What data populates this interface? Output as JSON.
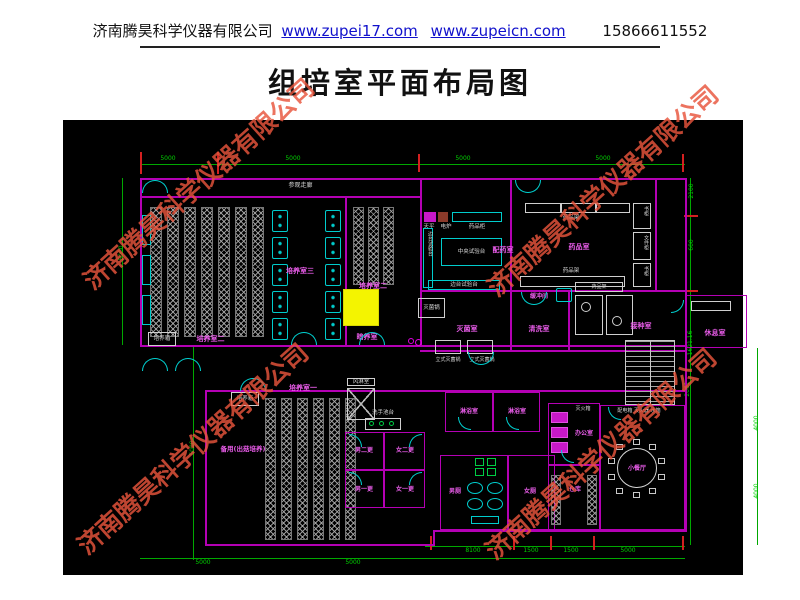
{
  "header": {
    "company": "济南腾昊科学仪器有限公司",
    "link1": "www.zupei17.com",
    "link2": "www.zupeicn.com",
    "phone": "15866611552"
  },
  "title": "组培室平面布局图",
  "watermark": {
    "text": "济南腾昊科学仪器有限公司",
    "color": "#e8543c"
  },
  "colors": {
    "wall": "#b400b4",
    "dimension": "#00a800",
    "fixture": "#00cccc",
    "room_label": "#e95ce9",
    "highlight": "#f4f400",
    "link": "#1111cc",
    "canvas": "#000000"
  },
  "plan": {
    "labels": {
      "corridor": "参观走廊",
      "room3": "培养室三",
      "room2": "培养室二",
      "room1": "培养室一",
      "dark": "暗养室",
      "incubator": "培养箱",
      "spare": "备用(出菇培养)",
      "pharmacy": "配药室",
      "centralBench": "中央试验台",
      "sideBench": "边台试验台",
      "balance": "天平",
      "stove": "电炉",
      "medCabinet": "药品柜",
      "medicineRoom": "药品室",
      "medShelf": "药品架",
      "bookcase": "书柜",
      "fileCabinet": "文件柜",
      "sterilRoom": "灭菌室",
      "autoclave": "灭菌锅",
      "autoclaveV": "立式灭菌锅",
      "washRoom": "清洗室",
      "buffer": "缓冲间",
      "inoculation": "接种室",
      "rest": "休息室",
      "utilities": "配电箱 灭火器 水箱",
      "airShower": "风淋室",
      "handWash": "洗手池台",
      "m2": "男二更",
      "f2": "女二更",
      "m1": "男一更",
      "f1": "女一更",
      "shower": "淋浴室",
      "mToilet": "男厕",
      "fToilet": "女厕",
      "office": "办公室",
      "fireBox": "灭火箱",
      "storage": "仓库",
      "dining": "小餐厅"
    },
    "dims": {
      "d5000": "5000",
      "d8100": "8100",
      "d1500": "1500",
      "d2100": "2100",
      "d600": "600",
      "d1621": "1621.16",
      "d2061": "2061",
      "d4000": "4000"
    }
  }
}
